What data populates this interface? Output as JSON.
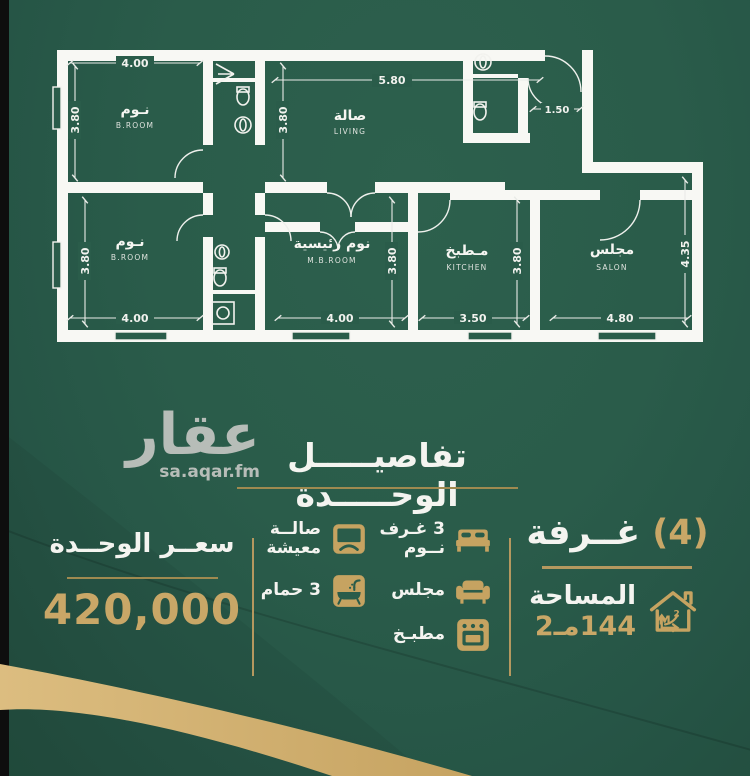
{
  "colors": {
    "background": "#2a5c4a",
    "wall_white": "#f8f8f4",
    "gold": "#c6a361",
    "gold_underline": "#9f8a50",
    "logo_gray": "#b7bdb8",
    "text_white": "#f4f4f0",
    "left_strip_black": "#0e0e0e",
    "swoosh_gold": "#d2b06c"
  },
  "floorplan": {
    "rooms": [
      {
        "id": "bedroom-top-left",
        "label_ar": "نـوم",
        "label_en": "B.ROOM",
        "width": "4.00",
        "depth": "3.80"
      },
      {
        "id": "living-room",
        "label_ar": "صالة",
        "label_en": "LIVING",
        "width": "5.80",
        "depth": "3.80"
      },
      {
        "id": "entry-bathroom",
        "width": "1.50"
      },
      {
        "id": "bedroom-bottom-left",
        "label_ar": "نـوم",
        "label_en": "B.ROOM",
        "width": "4.00",
        "depth": "3.80"
      },
      {
        "id": "master-bedroom",
        "label_ar": "نوم رئيسية",
        "label_en": "M.B.ROOM",
        "width": "4.00",
        "depth": "3.80"
      },
      {
        "id": "kitchen",
        "label_ar": "مـطبخ",
        "label_en": "KITCHEN",
        "width": "3.50",
        "depth": "3.80"
      },
      {
        "id": "salon",
        "label_ar": "مجلس",
        "label_en": "SALON",
        "width": "4.80",
        "depth": "4.35"
      }
    ]
  },
  "brand": {
    "logo_text": "عقار",
    "website": "sa.aqar.fm"
  },
  "section_title": "تفاصيـــــل الوحـــــدة",
  "unit": {
    "rooms_count": "(4)",
    "rooms_label": "غــرفة",
    "area_label": "المساحة",
    "area_value": "144مـ2",
    "price_label": "سعــر الوحــدة",
    "price_value": "420,000",
    "features": [
      {
        "id": "bedrooms",
        "line1": "3 غـرف",
        "line2": "نــوم"
      },
      {
        "id": "majlis",
        "line1": "مجلس",
        "line2": ""
      },
      {
        "id": "kitchen",
        "line1": "مطبـخ",
        "line2": ""
      },
      {
        "id": "living-hall",
        "line1": "صالــة",
        "line2": "معيشة"
      },
      {
        "id": "bathrooms",
        "line1": "3 حمام",
        "line2": ""
      }
    ]
  }
}
